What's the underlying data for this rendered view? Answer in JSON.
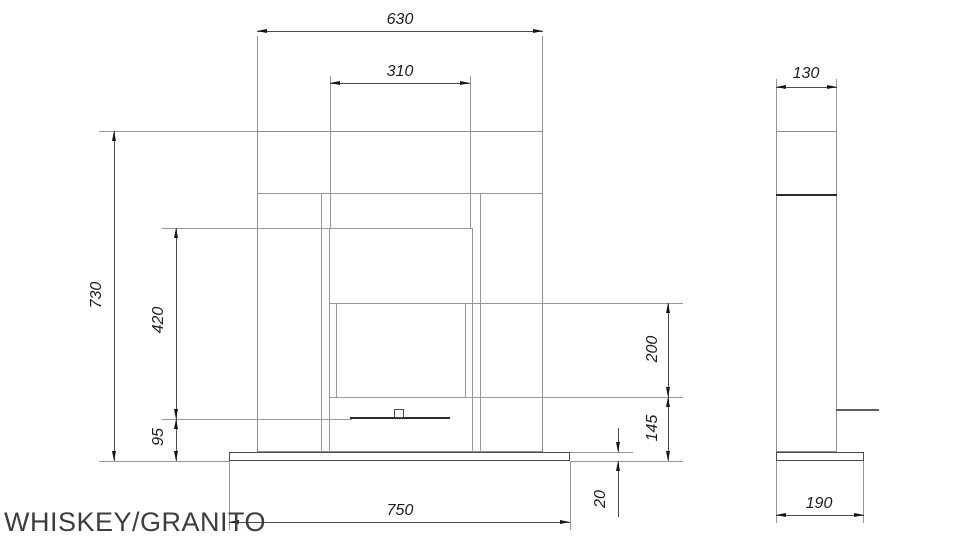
{
  "title": "WHISKEY/GRANITO",
  "dimensions": {
    "front": {
      "top_width": "630",
      "firebox_width": "310",
      "total_height": "730",
      "frame_to_burner_height": "420",
      "burner_above_floor": "95",
      "opening_height": "200",
      "opening_to_floor": "145",
      "base_thickness": "20",
      "base_width": "750"
    },
    "side": {
      "top_depth": "130",
      "base_depth": "190"
    }
  }
}
